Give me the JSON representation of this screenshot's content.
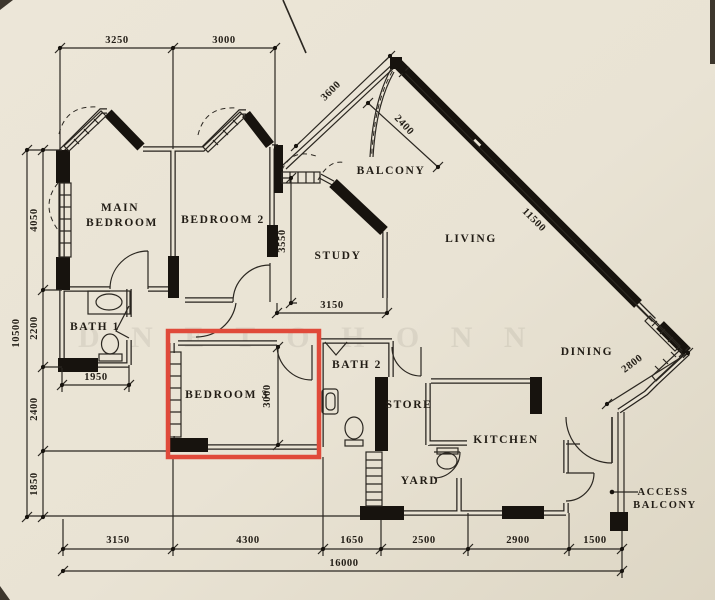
{
  "paper_color": "#e9e3d4",
  "ink_color": "#27231e",
  "highlight": {
    "color": "#e04a3a",
    "target_room": "BEDROOM 3"
  },
  "rooms": {
    "main_bedroom_line1": "MAIN",
    "main_bedroom_line2": "BEDROOM",
    "bedroom2": "BEDROOM 2",
    "study": "STUDY",
    "balcony": "BALCONY",
    "living": "LIVING",
    "dining": "DINING",
    "bath1": "BATH 1",
    "bedroom3": "BEDROOM 3",
    "bath2": "BATH 2",
    "store": "STORE",
    "kitchen": "KITCHEN",
    "yard": "YARD",
    "access_balcony_line1": "ACCESS",
    "access_balcony_line2": "BALCONY"
  },
  "dimensions": {
    "top": [
      "3250",
      "3000"
    ],
    "left_total": "10500",
    "left_segments": [
      "4050",
      "2200",
      "2400",
      "1850"
    ],
    "balcony_edge": "3600",
    "balcony_depth": "2400",
    "living_diagonal": "11500",
    "dining_diagonal": "2800",
    "bath1_width": "1950",
    "study_height": "3550",
    "study_width": "3150",
    "bedroom3_height": "3000",
    "bottom": [
      "3150",
      "4300",
      "1650",
      "2500",
      "2900",
      "1500"
    ],
    "bottom_total": "16000"
  },
  "watermark": "D N E T O H O N N"
}
